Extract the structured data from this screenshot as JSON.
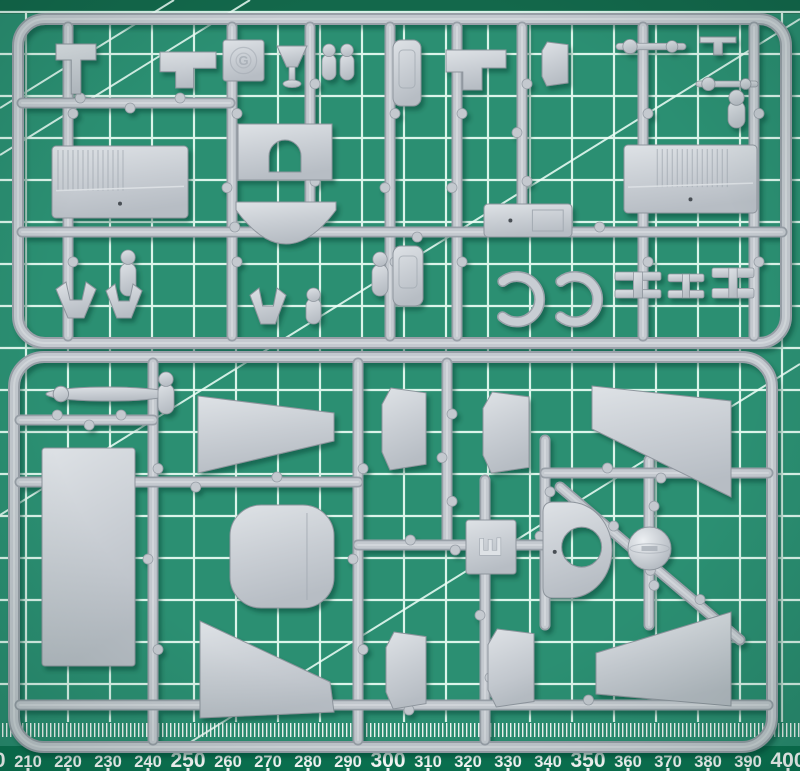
{
  "alt": "Two light-grey injection-moulded model aircraft sprues on a green self-healing cutting mat with white grid lines and a millimetre ruler scale",
  "colors": {
    "mat": "#2B8F72",
    "mat_band_top": "#13684B",
    "ruler_band": "#0B7351",
    "grid": "#EFFFF8",
    "tick": "#FFFFFF",
    "number": "#FFFFFF",
    "plastic": "#C8CDD3",
    "plastic_hi": "#DEE2E6",
    "plastic_sh": "#A3AAB2",
    "plastic_edge": "#8E959D",
    "runner": "#C4C9CF",
    "runner_edge": "#99A0A8",
    "ball_hi": "#EDF0F3",
    "detail_dot": "#4A4F55",
    "shadow": "#0C3D2C"
  },
  "mat": {
    "grid": {
      "step": 42,
      "x_offset": 26,
      "y_offset": 12,
      "bottom": 722
    },
    "diagonals": [
      [
        0,
        108,
        174,
        0
      ],
      [
        0,
        155,
        250,
        0
      ],
      [
        0,
        515,
        800,
        19
      ],
      [
        144,
        771,
        800,
        364
      ]
    ],
    "mm_ticks": {
      "y": 723,
      "h": 14,
      "step": 4
    },
    "ruler": {
      "band_y": 746,
      "band_h": 25,
      "baseline": 767,
      "origin_mm": 203,
      "px_per_mm": 4,
      "size_small": 16.5,
      "size_big": 21,
      "labels": [
        "200",
        "210",
        "220",
        "230",
        "240",
        "250",
        "260",
        "270",
        "280",
        "290",
        "300",
        "310",
        "320",
        "330",
        "340",
        "350",
        "360",
        "370",
        "380",
        "390",
        "400"
      ]
    }
  },
  "sprues": [
    {
      "name": "sprue-g",
      "letter": "G",
      "letter_style": "round-emboss",
      "letter_tab": {
        "x": 223,
        "y": 40,
        "w": 41,
        "h": 41
      },
      "frame": {
        "x": 18,
        "y": 19,
        "w": 768,
        "h": 324,
        "r": 27
      },
      "runners": [
        [
          68,
          27,
          68,
          336
        ],
        [
          232,
          27,
          232,
          336
        ],
        [
          310,
          27,
          310,
          230
        ],
        [
          390,
          27,
          390,
          336
        ],
        [
          457,
          27,
          457,
          336
        ],
        [
          522,
          27,
          522,
          230
        ],
        [
          643,
          27,
          643,
          336
        ],
        [
          754,
          27,
          754,
          336
        ],
        [
          22,
          103,
          230,
          103
        ],
        [
          22,
          232,
          782,
          232
        ]
      ],
      "parts": [
        {
          "name": "control-stick",
          "shape": "tee",
          "x": 56,
          "y": 44,
          "w": 40,
          "h": 50
        },
        {
          "name": "engine-bearer-left",
          "shape": "bracket",
          "x": 160,
          "y": 52,
          "w": 56,
          "h": 36
        },
        {
          "name": "pilot-seat",
          "shape": "goblet",
          "x": 277,
          "y": 46,
          "w": 30,
          "h": 42
        },
        {
          "name": "wheel-pin-a",
          "shape": "pin",
          "x": 322,
          "y": 44,
          "w": 14,
          "h": 36
        },
        {
          "name": "wheel-pin-b",
          "shape": "pin",
          "x": 340,
          "y": 44,
          "w": 14,
          "h": 36
        },
        {
          "name": "fuselage-former",
          "shape": "bottle",
          "x": 393,
          "y": 40,
          "w": 28,
          "h": 66
        },
        {
          "name": "engine-bearer-right",
          "shape": "bracket",
          "x": 446,
          "y": 50,
          "w": 60,
          "h": 40
        },
        {
          "name": "rudder-blade",
          "shape": "pent",
          "x": 542,
          "y": 42,
          "w": 26,
          "h": 44
        },
        {
          "name": "strut-rod-a",
          "shape": "rod",
          "x": 616,
          "y": 40,
          "w": 70,
          "h": 13
        },
        {
          "name": "small-fitting",
          "shape": "tee",
          "x": 700,
          "y": 37,
          "w": 36,
          "h": 18
        },
        {
          "name": "strut-rod-b",
          "shape": "rod",
          "x": 696,
          "y": 78,
          "w": 62,
          "h": 12
        },
        {
          "name": "gate-pin",
          "shape": "pin",
          "x": 728,
          "y": 90,
          "w": 17,
          "h": 38
        },
        {
          "name": "corrugated-panel-left",
          "shape": "corr",
          "x": 52,
          "y": 146,
          "w": 136,
          "h": 72,
          "hatch": "left"
        },
        {
          "name": "corrugated-panel-right",
          "shape": "corr",
          "x": 624,
          "y": 145,
          "w": 133,
          "h": 68,
          "hatch": "mid"
        },
        {
          "name": "cowling-arch",
          "shape": "arch",
          "x": 238,
          "y": 124,
          "w": 94,
          "h": 56
        },
        {
          "name": "cowling-bowl",
          "shape": "bowl",
          "x": 236,
          "y": 202,
          "w": 100,
          "h": 42
        },
        {
          "name": "exhaust-pin",
          "shape": "pin",
          "x": 120,
          "y": 250,
          "w": 16,
          "h": 46
        },
        {
          "name": "wheel-fork-a",
          "shape": "fork",
          "x": 56,
          "y": 282,
          "w": 40,
          "h": 36
        },
        {
          "name": "wheel-fork-b",
          "shape": "fork",
          "x": 106,
          "y": 284,
          "w": 36,
          "h": 34
        },
        {
          "name": "instrument-panel",
          "shape": "bottle",
          "x": 393,
          "y": 246,
          "w": 30,
          "h": 60
        },
        {
          "name": "mid-pin",
          "shape": "pin",
          "x": 372,
          "y": 252,
          "w": 16,
          "h": 44
        },
        {
          "name": "ammo-box",
          "shape": "boxd",
          "x": 484,
          "y": 204,
          "w": 88,
          "h": 33
        },
        {
          "name": "cowl-flap-half-a",
          "shape": "cclamp",
          "x": 474,
          "y": 272,
          "w": 32,
          "h": 54
        },
        {
          "name": "cowl-flap-half-b",
          "shape": "cclamp",
          "x": 532,
          "y": 272,
          "w": 32,
          "h": 54
        },
        {
          "name": "bomb-carrier-a",
          "shape": "tbar",
          "x": 615,
          "y": 272,
          "w": 46,
          "h": 26
        },
        {
          "name": "bomb-carrier-b",
          "shape": "tbar",
          "x": 668,
          "y": 274,
          "w": 36,
          "h": 24
        },
        {
          "name": "bomb-carrier-c",
          "shape": "tbar",
          "x": 712,
          "y": 268,
          "w": 42,
          "h": 30
        },
        {
          "name": "tail-fork",
          "shape": "fork",
          "x": 250,
          "y": 288,
          "w": 36,
          "h": 36
        },
        {
          "name": "lower-pin",
          "shape": "pin",
          "x": 306,
          "y": 288,
          "w": 15,
          "h": 36
        }
      ]
    },
    {
      "name": "sprue-e",
      "letter": "E",
      "letter_style": "emboss-rotated",
      "letter_tab": {
        "x": 466,
        "y": 520,
        "w": 50,
        "h": 54
      },
      "frame": {
        "x": 14,
        "y": 357,
        "w": 758,
        "h": 390,
        "r": 30
      },
      "runners": [
        [
          153,
          363,
          153,
          740
        ],
        [
          358,
          363,
          358,
          740
        ],
        [
          447,
          363,
          447,
          545
        ],
        [
          485,
          480,
          485,
          740
        ],
        [
          545,
          440,
          545,
          625
        ],
        [
          649,
          460,
          649,
          625
        ],
        [
          20,
          420,
          153,
          420
        ],
        [
          20,
          482,
          358,
          482
        ],
        [
          358,
          545,
          545,
          545
        ],
        [
          545,
          473,
          768,
          473
        ],
        [
          20,
          705,
          768,
          705
        ],
        [
          560,
          487,
          740,
          640
        ]
      ],
      "parts": [
        {
          "name": "propeller-blade",
          "shape": "blade",
          "x": 46,
          "y": 387,
          "w": 124,
          "h": 14
        },
        {
          "name": "hub-pin",
          "shape": "pin",
          "x": 158,
          "y": 372,
          "w": 16,
          "h": 42
        },
        {
          "name": "fuselage-side-panel",
          "shape": "rect",
          "x": 42,
          "y": 448,
          "w": 93,
          "h": 218
        },
        {
          "name": "wing-panel-upper-left",
          "shape": "quad",
          "pts": [
            [
              198,
              396
            ],
            [
              334,
              413
            ],
            [
              334,
              441
            ],
            [
              198,
              473
            ]
          ]
        },
        {
          "name": "wing-center-panel",
          "shape": "squircle",
          "x": 230,
          "y": 505,
          "w": 104,
          "h": 103,
          "seam": 0.74
        },
        {
          "name": "wing-panel-lower-left",
          "shape": "quad",
          "pts": [
            [
              200,
              621
            ],
            [
              330,
              682
            ],
            [
              334,
              712
            ],
            [
              200,
              718
            ]
          ]
        },
        {
          "name": "flap-panel-a",
          "shape": "pent",
          "x": 382,
          "y": 388,
          "w": 44,
          "h": 82
        },
        {
          "name": "flap-panel-b",
          "shape": "pent",
          "x": 483,
          "y": 392,
          "w": 46,
          "h": 81
        },
        {
          "name": "flap-panel-c",
          "shape": "pent",
          "x": 386,
          "y": 632,
          "w": 40,
          "h": 77
        },
        {
          "name": "flap-panel-d",
          "shape": "pent",
          "x": 488,
          "y": 629,
          "w": 46,
          "h": 78
        },
        {
          "name": "cowl-bulkhead",
          "shape": "dshape",
          "x": 543,
          "y": 502,
          "w": 69,
          "h": 96
        },
        {
          "name": "spinner-ball",
          "shape": "ball",
          "x": 628,
          "y": 527,
          "w": 43,
          "h": 43
        },
        {
          "name": "tailplane-upper-right",
          "shape": "quad",
          "pts": [
            [
              592,
              386
            ],
            [
              731,
              401
            ],
            [
              731,
              497
            ],
            [
              592,
              429
            ]
          ]
        },
        {
          "name": "tailplane-lower-right",
          "shape": "quad",
          "pts": [
            [
              596,
              653
            ],
            [
              731,
              612
            ],
            [
              731,
              706
            ],
            [
              596,
              694
            ]
          ]
        }
      ]
    }
  ]
}
